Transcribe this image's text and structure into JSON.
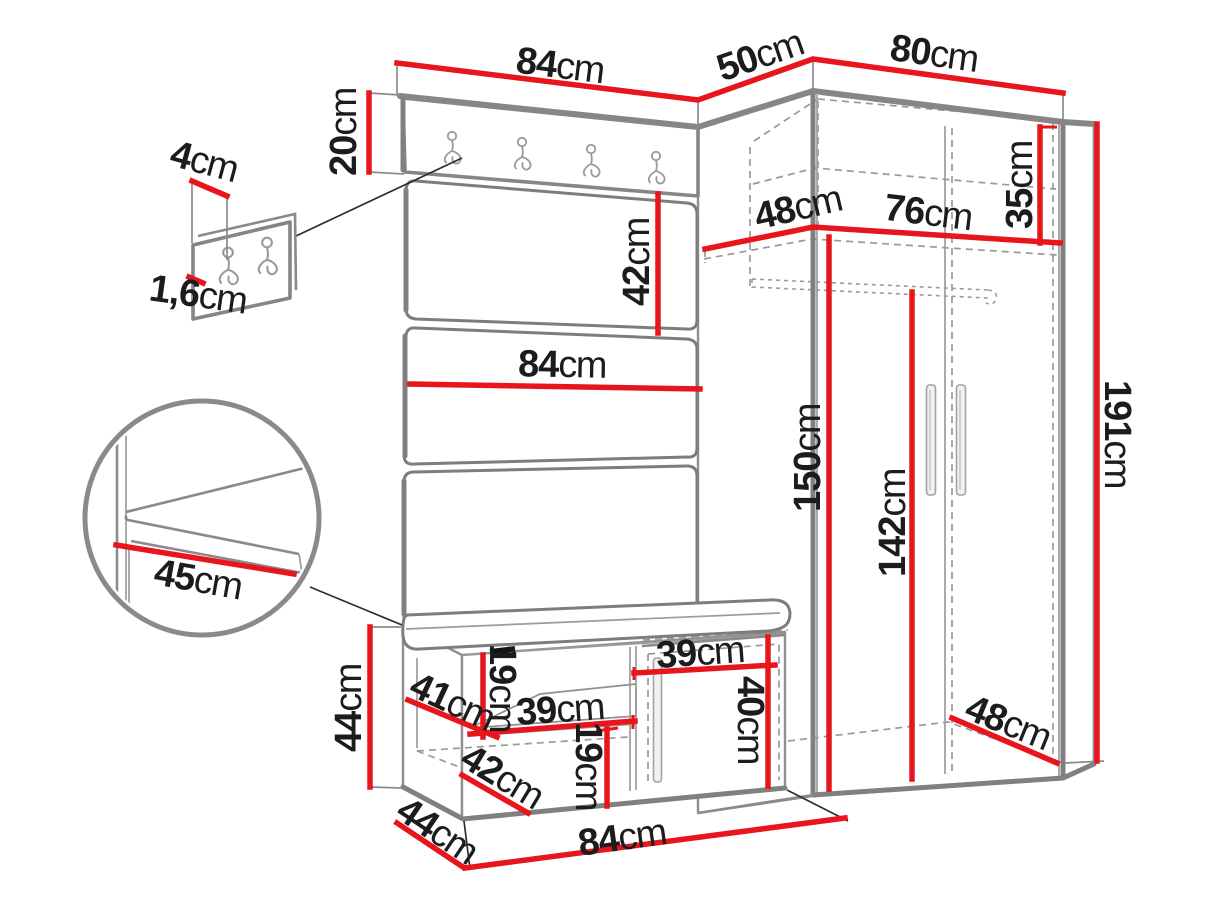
{
  "colors": {
    "dimension_red": "#e8151c",
    "outline_gray": "#8a8a8a",
    "label_ink": "#1c1c1c",
    "background": "#ffffff"
  },
  "icons": {
    "coat_hook_board_icons": "double-coat-hook-icon x4",
    "coat_hook_detail_icons": "double-coat-hook-icon x2",
    "wardrobe_handle_icons": "door-handle-bar-icon x2"
  },
  "dimensions": {
    "panel_top_width": {
      "value": "84",
      "unit": "cm"
    },
    "corner_top_width": {
      "value": "50",
      "unit": "cm"
    },
    "wardrobe_top_width": {
      "value": "80",
      "unit": "cm"
    },
    "hook_board_height": {
      "value": "20",
      "unit": "cm"
    },
    "hook_width": {
      "value": "4",
      "unit": "cm"
    },
    "hook_panel_thickness": {
      "value": "1,6",
      "unit": "cm"
    },
    "panel_section_height": {
      "value": "42",
      "unit": "cm"
    },
    "shelf_depth": {
      "value": "48",
      "unit": "cm"
    },
    "shelf_width": {
      "value": "76",
      "unit": "cm"
    },
    "top_section_height": {
      "value": "35",
      "unit": "cm"
    },
    "panel_width": {
      "value": "84",
      "unit": "cm"
    },
    "interior_height_left": {
      "value": "150",
      "unit": "cm"
    },
    "interior_height_right": {
      "value": "142",
      "unit": "cm"
    },
    "wardrobe_height": {
      "value": "191",
      "unit": "cm"
    },
    "seat_depth_detail": {
      "value": "45",
      "unit": "cm"
    },
    "bench_height": {
      "value": "44",
      "unit": "cm"
    },
    "bench_shelf_diag": {
      "value": "41",
      "unit": "cm"
    },
    "bench_upper_gap": {
      "value": "19",
      "unit": "cm"
    },
    "bench_shelf_width": {
      "value": "39",
      "unit": "cm"
    },
    "bench_lower_diag": {
      "value": "42",
      "unit": "cm"
    },
    "bench_lower_gap": {
      "value": "19",
      "unit": "cm"
    },
    "bench_door_width": {
      "value": "39",
      "unit": "cm"
    },
    "bench_door_height": {
      "value": "40",
      "unit": "cm"
    },
    "bench_depth": {
      "value": "44",
      "unit": "cm"
    },
    "bench_width": {
      "value": "84",
      "unit": "cm"
    },
    "wardrobe_depth": {
      "value": "48",
      "unit": "cm"
    }
  }
}
